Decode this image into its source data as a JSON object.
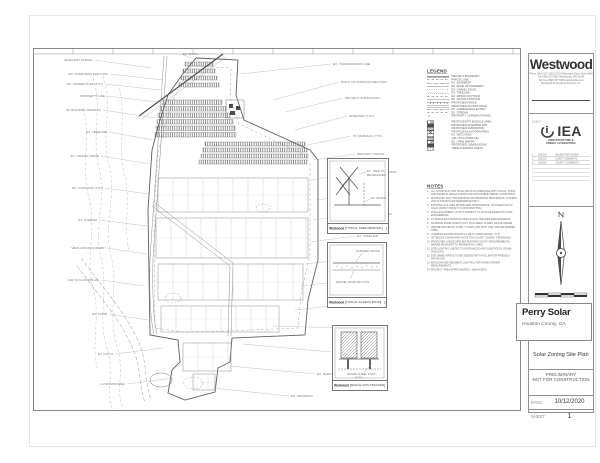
{
  "plan": {
    "callouts": [
      {
        "x": 75,
        "y": 26,
        "lx": 130,
        "ly": 32,
        "a": "e",
        "t": "EX. OVERHEAD ELECTRIC"
      },
      {
        "x": 70,
        "y": 36,
        "lx": 127,
        "ly": 42,
        "a": "e",
        "t": "EX. POWER POLE (TYP.)"
      },
      {
        "x": 72,
        "y": 48,
        "lx": 124,
        "ly": 54,
        "a": "e",
        "t": "PROPERTY LINE"
      },
      {
        "x": 68,
        "y": 62,
        "lx": 122,
        "ly": 70,
        "a": "e",
        "t": "50' BUILDING SETBACK"
      },
      {
        "x": 74,
        "y": 84,
        "lx": 120,
        "ly": 92,
        "a": "e",
        "t": "EX. TREELINE"
      },
      {
        "x": 66,
        "y": 108,
        "lx": 117,
        "ly": 116,
        "a": "e",
        "t": "EX. GRAVEL DRIVE"
      },
      {
        "x": 70,
        "y": 140,
        "lx": 116,
        "ly": 146,
        "a": "e",
        "t": "EX. CONTOUR (TYP.)"
      },
      {
        "x": 64,
        "y": 172,
        "lx": 114,
        "ly": 178,
        "a": "e",
        "t": "EX. STREAM"
      },
      {
        "x": 72,
        "y": 200,
        "lx": 113,
        "ly": 206,
        "a": "e",
        "t": "WETLAND BOUNDARY"
      },
      {
        "x": 66,
        "y": 232,
        "lx": 112,
        "ly": 238,
        "a": "e",
        "t": "100-YR FLOODPLAIN"
      },
      {
        "x": 74,
        "y": 266,
        "lx": 115,
        "ly": 272,
        "a": "e",
        "t": "EX. POND"
      },
      {
        "x": 80,
        "y": 306,
        "lx": 130,
        "ly": 300,
        "a": "e",
        "t": "EX. DITCH"
      },
      {
        "x": 92,
        "y": 336,
        "lx": 140,
        "ly": 330,
        "a": "e",
        "t": "LAYDOWN AREA"
      },
      {
        "x": 60,
        "y": 12,
        "lx": 118,
        "ly": 20,
        "a": "e",
        "t": "ADJACENT PARCEL"
      },
      {
        "x": 150,
        "y": 6,
        "lx": 168,
        "ly": 14,
        "a": "s",
        "t": "EX. ROAD"
      },
      {
        "x": 300,
        "y": 16,
        "lx": 208,
        "ly": 26,
        "a": "s",
        "t": "EX. TRANSMISSION LINE"
      },
      {
        "x": 308,
        "y": 34,
        "lx": 240,
        "ly": 52,
        "a": "s",
        "t": "POINT OF INTERCONNECTION"
      },
      {
        "x": 312,
        "y": 50,
        "lx": 252,
        "ly": 64,
        "a": "s",
        "t": "PROJECT SUBSTATION"
      },
      {
        "x": 316,
        "y": 68,
        "lx": 262,
        "ly": 82,
        "a": "s",
        "t": "INVERTER (TYP.)"
      },
      {
        "x": 320,
        "y": 88,
        "lx": 270,
        "ly": 98,
        "a": "s",
        "t": "PV MODULES (TYP.)"
      },
      {
        "x": 324,
        "y": 106,
        "lx": 280,
        "ly": 112,
        "a": "s",
        "t": "SECURITY FENCE"
      },
      {
        "x": 328,
        "y": 124,
        "lx": 278,
        "ly": 132,
        "a": "s",
        "t": "GRAVEL ACCESS ROAD"
      },
      {
        "x": 332,
        "y": 146,
        "lx": 283,
        "ly": 152,
        "a": "s",
        "t": "PROPERTY LINE"
      },
      {
        "x": 328,
        "y": 166,
        "lx": 280,
        "ly": 172,
        "a": "s",
        "t": "25' FENCE SETBACK"
      },
      {
        "x": 324,
        "y": 188,
        "lx": 277,
        "ly": 194,
        "a": "s",
        "t": "EX. TREELINE"
      },
      {
        "x": 328,
        "y": 210,
        "lx": 272,
        "ly": 216,
        "a": "s",
        "t": "EX. FARM POND"
      },
      {
        "x": 322,
        "y": 232,
        "lx": 268,
        "ly": 238,
        "a": "s",
        "t": "MODULE SETBACK"
      },
      {
        "x": 318,
        "y": 256,
        "lx": 262,
        "ly": 262,
        "a": "s",
        "t": "EX. FIELD ROAD"
      },
      {
        "x": 310,
        "y": 280,
        "lx": 240,
        "ly": 278,
        "a": "s",
        "t": "O&M BUILDING"
      },
      {
        "x": 300,
        "y": 304,
        "lx": 210,
        "ly": 296,
        "a": "s",
        "t": "EX. WELL"
      },
      {
        "x": 284,
        "y": 326,
        "lx": 196,
        "ly": 318,
        "a": "s",
        "t": "EX. BARN"
      },
      {
        "x": 258,
        "y": 348,
        "lx": 180,
        "ly": 340,
        "a": "s",
        "t": "EX. DRIVEWAY"
      }
    ]
  },
  "legend": {
    "title": "LEGEND",
    "groups": [
      {
        "items": [
          {
            "s": "sym-bold",
            "t": "PROJECT BOUNDARY"
          },
          {
            "s": "sym-dash",
            "t": "PARCEL LINE"
          },
          {
            "s": "sym-dashdot",
            "t": "EX. EASEMENT"
          },
          {
            "s": "sym-solid",
            "t": "EX. EDGE OF PAVEMENT"
          },
          {
            "s": "sym-dots",
            "t": "EX. GRAVEL ROAD"
          },
          {
            "s": "sym-zig",
            "t": "EX. TREELINE"
          },
          {
            "s": "sym-dash",
            "t": "EX. MINOR CONTOUR"
          },
          {
            "s": "sym-solid",
            "t": "EX. MAJOR CONTOUR"
          },
          {
            "s": "sym-ticks",
            "t": "PROPOSED FENCE"
          },
          {
            "s": "sym-double",
            "t": "PROPOSED ACCESS ROAD"
          },
          {
            "s": "sym-dashdot",
            "t": "EX. OVERHEAD ELECTRIC"
          },
          {
            "s": "sym-dash",
            "t": "EX. STREAM"
          },
          {
            "s": "sym-dot",
            "t": "PROPERTY CORNER (FOUND)"
          }
        ]
      },
      {
        "items": [
          {
            "s": "bx-hatch",
            "t": "PROPOSED PV MODULE AREA"
          },
          {
            "s": "bx-dark",
            "t": "PROPOSED INVERTER PAD"
          },
          {
            "s": "bx-gray",
            "t": "PROPOSED SUBSTATION"
          },
          {
            "s": "bx-x",
            "t": "PROPOSED LAYDOWN AREA"
          },
          {
            "s": "bx-dots",
            "t": "EX. WETLANDS"
          },
          {
            "s": "bx-gray",
            "t": "100-YR FLOODPLAIN"
          },
          {
            "s": "bx-hatch",
            "t": "EX. OPEN WATER"
          },
          {
            "s": "bx-dark",
            "t": "PROPOSED O&M BUILDING"
          },
          {
            "s": "bx-dots",
            "t": "TREE CLEARING LIMITS"
          }
        ]
      }
    ]
  },
  "notes": {
    "title": "NOTES",
    "items": [
      "ALL CONSTRUCTION SHALL BE IN ACCORDANCE WITH LOCAL, STATE AND FEDERAL REGULATIONS AND APPLICABLE PERMIT CONDITIONS.",
      "BOUNDARY AND TOPOGRAPHIC INFORMATION PROVIDED BY OTHERS AND IS SHOWN FOR REFERENCE ONLY.",
      "EXISTING UTILITIES SHOWN ARE APPROXIMATE. CONTRACTOR TO FIELD VERIFY PRIOR TO CONSTRUCTION.",
      "FINAL EQUIPMENT LAYOUT SUBJECT TO CHANGE BASED ON FINAL ENGINEERING.",
      "PV MODULES SHOWN AS SINGLE AXIS TRACKER ARRANGEMENT.",
      "MAXIMUM PANEL HEIGHT NOT TO EXCEED 15 FEET ABOVE GRADE.",
      "PERIMETER FENCE TO BE 7' CHAIN LINK WITH ONE STRAND BARBED WIRE.",
      "INTERIOR ACCESS ROADS TO BE 16' WIDE GRAVEL, TYP.",
      "SETBACKS SHOWN PER HOUSTON COUNTY ZONING ORDINANCE.",
      "PROPOSED LANDSCAPE BUFFER PER COUNTY REQUIREMENTS WHERE ADJACENT TO RESIDENTIAL USES.",
      "SITE LIGHTING LIMITED TO ENTRANCES AND SUBSTATION, DOWN-SHIELDED.",
      "DISTURBED AREAS TO BE SEEDED WITH POLLINATOR-FRIENDLY NATIVE MIX.",
      "EROSION AND SEDIMENT CONTROL PER NPDES PERMIT REQUIREMENTS.",
      "PROJECT AREA APPROXIMATELY ±680 ACRES."
    ]
  },
  "details": [
    {
      "title": "TYPICAL TREE REMOVAL",
      "number": "1",
      "labels": [
        "EX. TREE TO",
        "BE REMOVED",
        "EX. GRADE"
      ]
    },
    {
      "title": "TYPICAL ACCESS ROAD",
      "number": "2",
      "labels": [
        "FINISHED GRADE",
        "GRAVEL ROAD SECTION"
      ]
    },
    {
      "title": "SINGLE AXIS TRACKER",
      "number": "3",
      "labels": [
        "DRIVEN STEEL POST",
        "(TYP.)"
      ]
    }
  ],
  "titleblock": {
    "firm": {
      "name": "Westwood",
      "lines": [
        "Phone (952) 937-5150    12701 Whitewater Drive, Suite #300",
        "Fax (952) 937-5822    Minnetonka, MN 55343",
        "Toll Free (888) 937-5150    westwoodps.com",
        "Westwood Professional Services, Inc."
      ]
    },
    "client": {
      "label": "CLIENT",
      "name": "IEA",
      "tagline1": "INFRASTRUCTURE &",
      "tagline2": "ENERGY ALTERNATIVES"
    },
    "revisions": {
      "rows": [
        {
          "no": "1",
          "date": "10/12/20",
          "desc": "ISSUED FOR ZONING"
        },
        {
          "no": "2",
          "date": "10/12/20",
          "desc": "CLIENT COMMENTS"
        },
        {
          "no": "3",
          "date": "10/12/20",
          "desc": "COUNTY COMMENTS"
        }
      ]
    },
    "project": {
      "name": "Perry Solar",
      "location": "Houston County, GA"
    },
    "sheet_title": "Solar Zoning Site Plan",
    "status_line1": "PRELIMINARY",
    "status_line2": "NOT FOR CONSTRUCTION",
    "date_label": "DATE",
    "date_value": "10/12/2020",
    "sheet_label": "SHEET",
    "sheet_number": "1"
  }
}
